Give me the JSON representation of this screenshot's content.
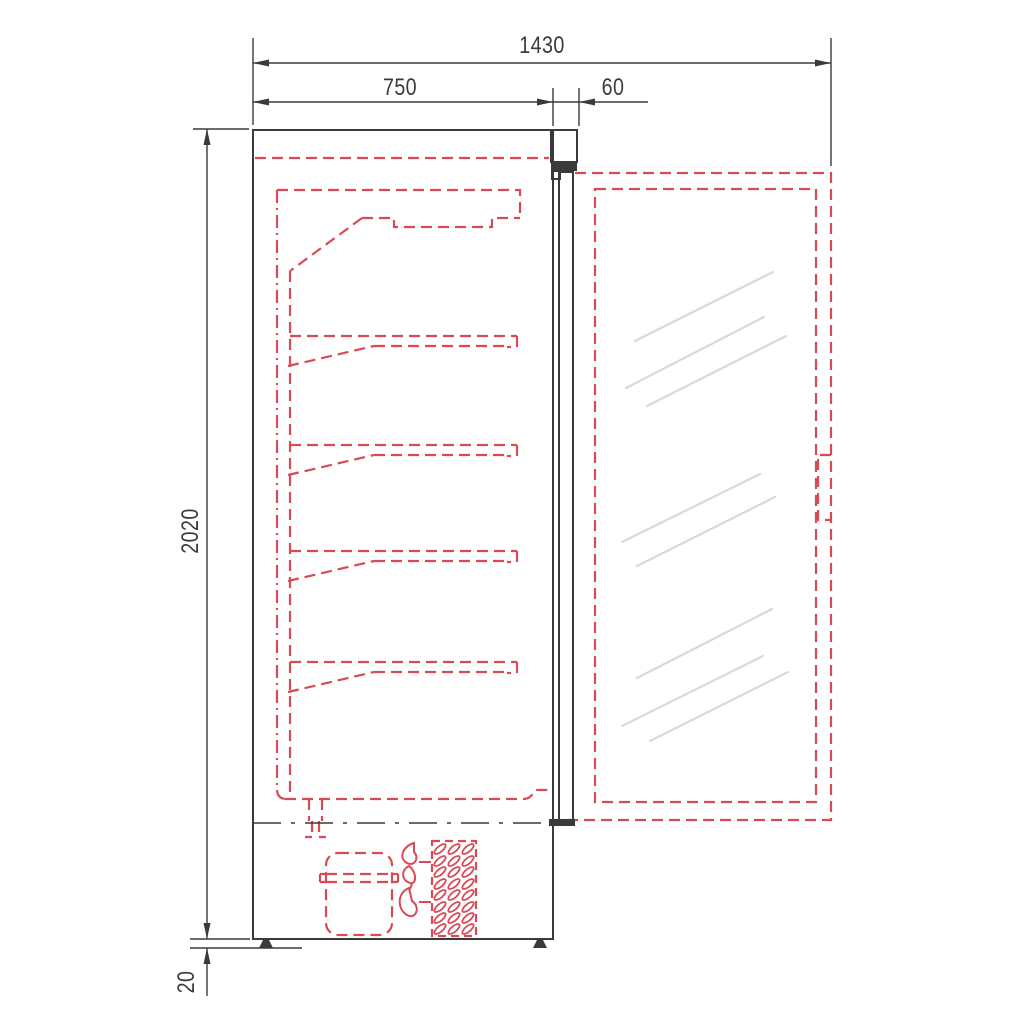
{
  "dimensions": {
    "overall_width": "1430",
    "body_depth": "750",
    "door_thickness": "60",
    "overall_height": "2020",
    "ground_clearance": "20"
  },
  "colors": {
    "outline": "#3a3a3a",
    "hidden": "#d84a56",
    "glass": "#d9d9d9",
    "background": "#ffffff"
  }
}
